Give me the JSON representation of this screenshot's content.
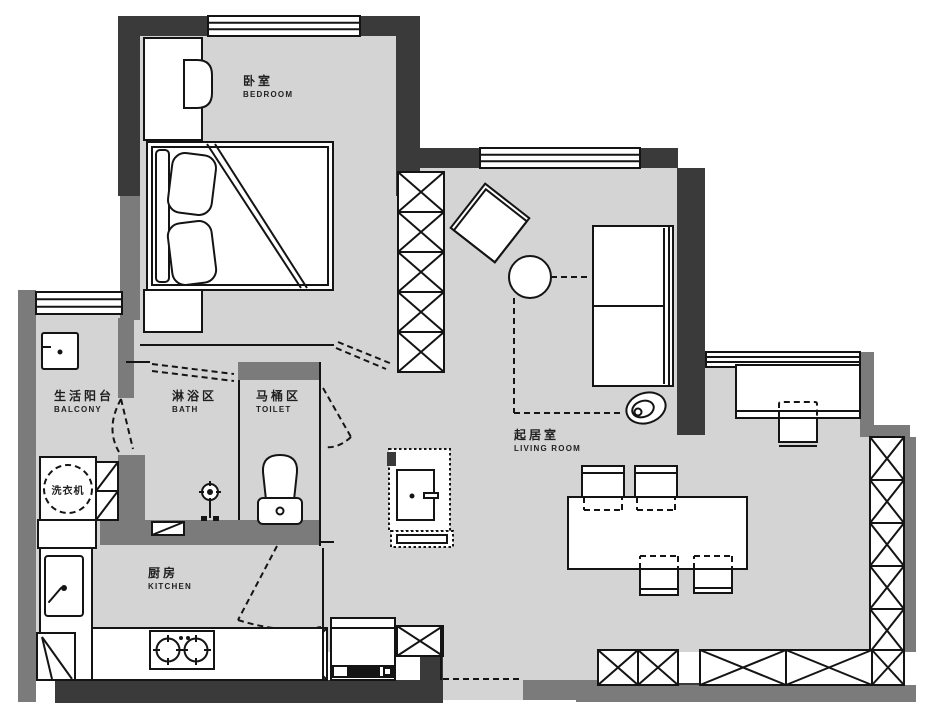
{
  "rooms": [
    {
      "id": "bedroom",
      "name_zh": "卧室",
      "name_en": "BEDROOM"
    },
    {
      "id": "living-room",
      "name_zh": "起居室",
      "name_en": "LIVING ROOM"
    },
    {
      "id": "kitchen",
      "name_zh": "厨房",
      "name_en": "KITCHEN"
    },
    {
      "id": "balcony",
      "name_zh": "生活阳台",
      "name_en": "BALCONY"
    },
    {
      "id": "bath",
      "name_zh": "淋浴区",
      "name_en": "BATH"
    },
    {
      "id": "toilet",
      "name_zh": "马桶区",
      "name_en": "TOILET"
    }
  ],
  "appliances": {
    "washing_machine": "洗衣机"
  },
  "colors": {
    "floor": "#d4d4d4",
    "wall_primary": "#3a3a3a",
    "wall_secondary": "#7b7b7b",
    "line": "#141414",
    "background": "#ffffff"
  }
}
